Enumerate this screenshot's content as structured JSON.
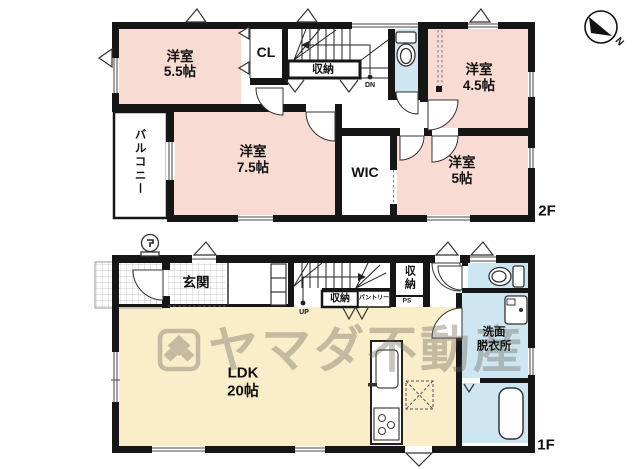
{
  "plan": {
    "compass": {
      "north_label": "N"
    },
    "watermark": {
      "company": "ヤマダ不動産"
    },
    "floor2": {
      "floor_label": "2F",
      "stairs": {
        "direction_label": "DN"
      },
      "rooms": {
        "bedroom_55": {
          "name": "洋室",
          "size": "5.5帖"
        },
        "closet_cl": {
          "name": "CL"
        },
        "storage": {
          "name": "収納"
        },
        "bedroom_45": {
          "name": "洋室",
          "size": "4.5帖"
        },
        "balcony": {
          "name": "バルコニー"
        },
        "bedroom_75": {
          "name": "洋室",
          "size": "7.5帖"
        },
        "wic": {
          "name": "WIC"
        },
        "bedroom_50": {
          "name": "洋室",
          "size": "5帖"
        }
      }
    },
    "floor1": {
      "floor_label": "1F",
      "stairs": {
        "direction_label": "UP"
      },
      "rooms": {
        "genkan": {
          "name": "玄関"
        },
        "storage_under_stairs": {
          "name": "収納"
        },
        "pantry": {
          "name": "パントリー"
        },
        "storage_hall": {
          "name": "収納"
        },
        "pipe_space": {
          "name": "PS"
        },
        "washroom": {
          "name_line1": "洗面",
          "name_line2": "脱衣所"
        },
        "ldk": {
          "name": "LDK",
          "size": "20帖"
        }
      }
    },
    "colors": {
      "wall": "#161616",
      "room_pink": "#f8dbd2",
      "room_blue": "#cde6f1",
      "room_cream": "#f9edca",
      "watermark_gray": "rgba(110,103,90,0.38)"
    }
  }
}
